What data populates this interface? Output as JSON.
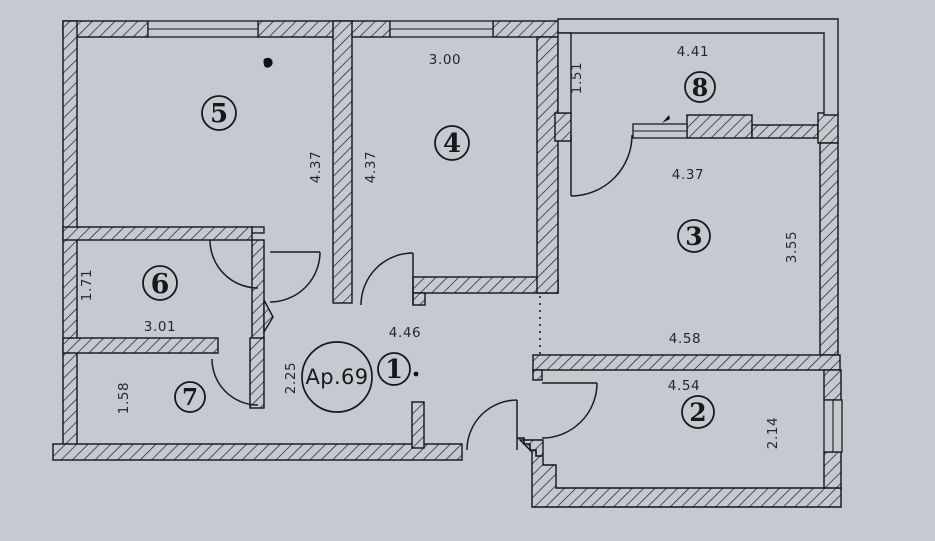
{
  "plan": {
    "type": "apartment-floor-plan",
    "apartment_label": "Ap.69",
    "background_color": "#c6c9cf",
    "line_color": "#1b1c1f",
    "room_numbers": {
      "r1": "1",
      "r2": "2",
      "r3": "3",
      "r4": "4",
      "r5": "5",
      "r6": "6",
      "r7": "7",
      "r8": "8"
    },
    "dimensions": {
      "hall_width": "4.46",
      "hall_depth": "2.25",
      "room2_width": "4.54",
      "room2_depth": "2.14",
      "room3_width": "4.37",
      "room3_depth": "3.55",
      "room3_width_bottom": "4.58",
      "room4_width": "3.00",
      "room4_depth": "4.37",
      "room5_depth": "4.37",
      "room6_width": "3.01",
      "room6_depth": "1.71",
      "room7_depth": "1.58",
      "room8_width": "4.41",
      "room8_depth": "1.51"
    }
  }
}
